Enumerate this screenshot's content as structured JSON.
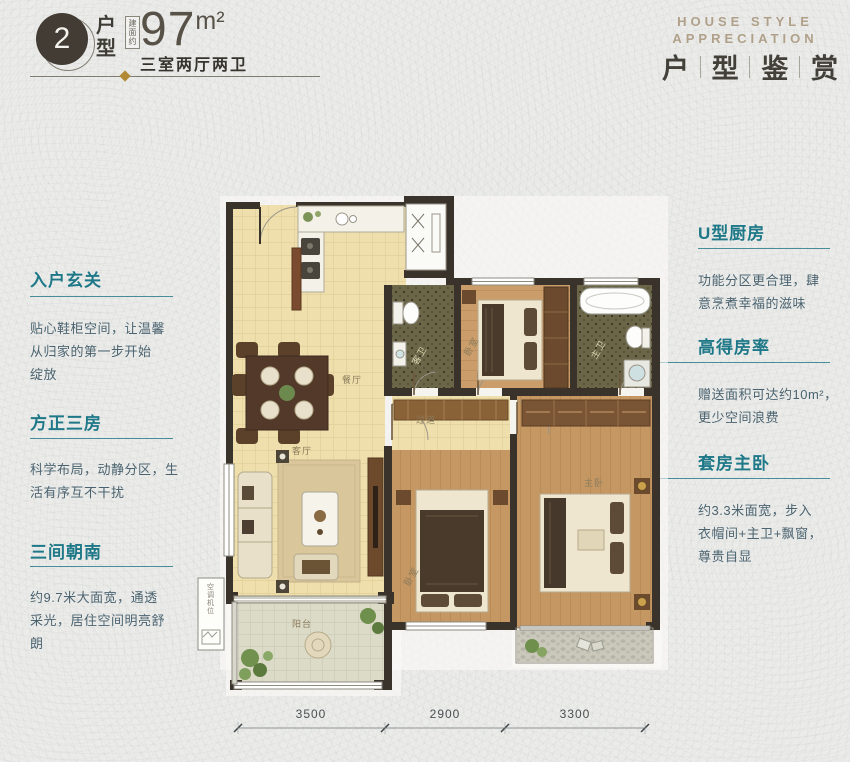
{
  "theme": {
    "teal": "#1e7888",
    "gold": "#b28a33",
    "tan": "#b1a089",
    "wall": "#3a332b",
    "bg": "#ebecea"
  },
  "header": {
    "unit_number": "2",
    "unit_label_chars": [
      "户",
      "型"
    ],
    "area_prefix": "建面约",
    "area_value": "97",
    "area_unit": "m²",
    "spec": "三室两厅两卫",
    "right_en_line1": "HOUSE STYLE",
    "right_en_line2": "APPRECIATION",
    "right_cn_chars": [
      "户",
      "型",
      "鉴",
      "赏"
    ]
  },
  "annotations": {
    "left": [
      {
        "title": "入户玄关",
        "body": [
          "贴心鞋柜空间，让温馨",
          "从归家的第一步开始",
          "绽放"
        ]
      },
      {
        "title": "方正三房",
        "body": [
          "科学布局，动静分区，生",
          "活有序互不干扰",
          ""
        ]
      },
      {
        "title": "三间朝南",
        "body": [
          "约9.7米大面宽，通透",
          "采光，居住空间明亮舒",
          "朗"
        ]
      }
    ],
    "right": [
      {
        "title": "U型厨房",
        "body": [
          "功能分区更合理，肆",
          "意烹煮幸福的滋味",
          ""
        ]
      },
      {
        "title": "高得房率",
        "body": [
          "赠送面积可达约10m²，",
          "更少空间浪费",
          ""
        ]
      },
      {
        "title": "套房主卧",
        "body": [
          "约3.3米面宽，步入",
          "衣帽间+主卫+飘窗，",
          "尊贵自显"
        ]
      }
    ]
  },
  "floorplan": {
    "rooms": [
      {
        "name": "餐厅",
        "x": 162,
        "y": 193
      },
      {
        "name": "客厅",
        "x": 112,
        "y": 264
      },
      {
        "name": "阳台",
        "x": 112,
        "y": 437
      },
      {
        "name": "过道",
        "x": 236,
        "y": 233
      },
      {
        "name": "卧室",
        "x": 284,
        "y": 158,
        "rotate": -60
      },
      {
        "name": "卧室",
        "x": 224,
        "y": 388,
        "rotate": -60
      },
      {
        "name": "主卧",
        "x": 404,
        "y": 296
      },
      {
        "name": "客卫",
        "x": 232,
        "y": 167,
        "rotate": -60,
        "light": true
      },
      {
        "name": "主卫",
        "x": 411,
        "y": 161,
        "rotate": -60,
        "light": true
      },
      {
        "name": "空调机位",
        "x": 21,
        "y": 399,
        "vertical": true
      }
    ],
    "dimensions": {
      "values": [
        "3500",
        "2900",
        "3300"
      ],
      "ticks": [
        10,
        157,
        277,
        417
      ],
      "label_x": [
        83,
        217,
        347
      ]
    }
  }
}
